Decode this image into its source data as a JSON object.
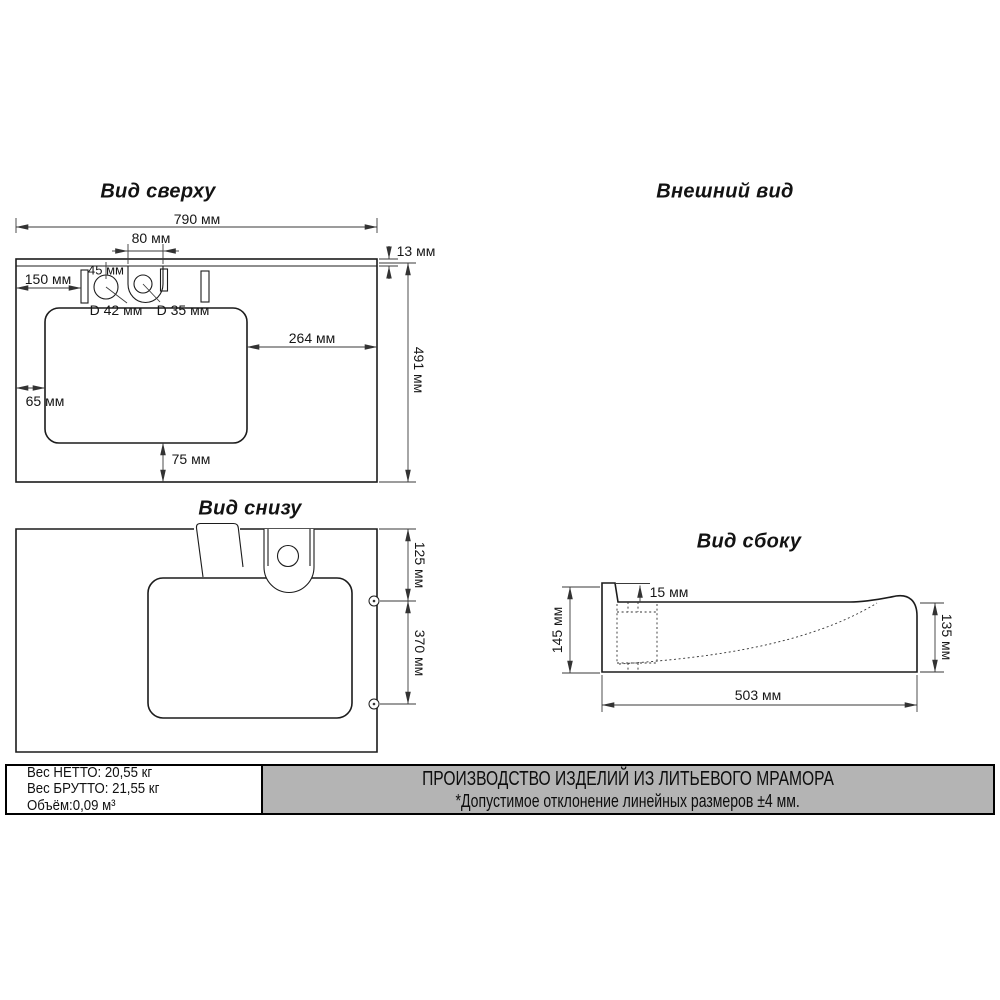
{
  "colors": {
    "banner_bg": "#b4b4b4",
    "line": "#1c1c1c",
    "dim_line": "#3a3a3a"
  },
  "views": {
    "top": {
      "title": "Вид сверху",
      "dims": {
        "overall_width": "790 мм",
        "tap_arch_width": "80 мм",
        "rim_depth": "13 мм",
        "left_offset": "150 мм",
        "hole_offset": "45 мм",
        "drain_hole_diameter": "D 42 мм",
        "tap_hole_diameter": "D 35 мм",
        "right_offset": "264 мм",
        "overall_depth": "491 мм",
        "basin_left_gap": "65 мм",
        "basin_bottom_gap": "75 мм"
      }
    },
    "external": {
      "title": "Внешний вид"
    },
    "bottom": {
      "title": "Вид снизу",
      "dims": {
        "screw_top_offset": "125 мм",
        "screw_spacing": "370 мм"
      }
    },
    "side": {
      "title": "Вид сбоку",
      "dims": {
        "back_ledge": "15 мм",
        "back_height": "145 мм",
        "front_height": "135 мм",
        "depth": "503 мм"
      }
    }
  },
  "info_box": {
    "net_weight": "Вес НЕТТО: 20,55 кг",
    "gross_weight": "Вес БРУТТО: 21,55 кг",
    "volume": "Объём:0,09 м³"
  },
  "banner": {
    "line1": "ПРОИЗВОДСТВО ИЗДЕЛИЙ ИЗ ЛИТЬЕВОГО МРАМОРА",
    "line2": "*Допустимое отклонение линейных размеров ±4 мм."
  }
}
